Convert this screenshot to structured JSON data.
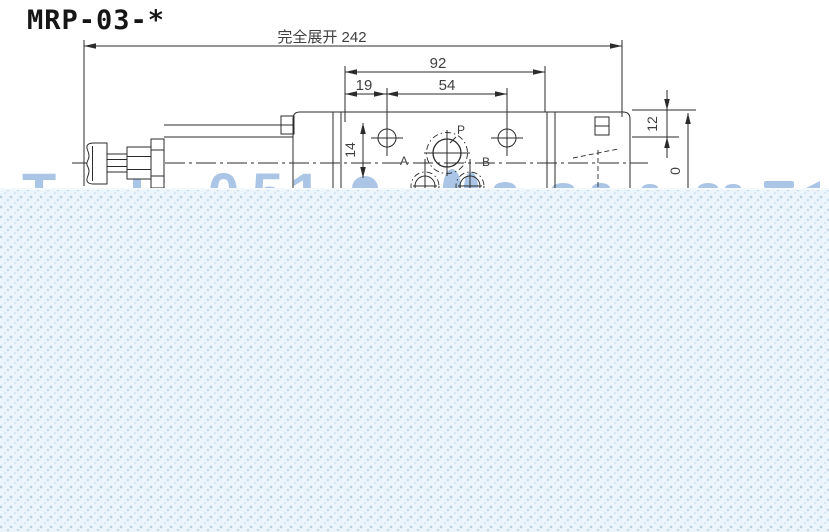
{
  "title": "MRP-03-*",
  "dimensions": {
    "overall_extended": "完全展开 242",
    "body_width": "92",
    "edge_to_hole": "19",
    "hole_spacing": "54",
    "hole_offset": "14",
    "top_height": "12",
    "partial_height": "0"
  },
  "port_labels": {
    "p": "P",
    "a": "A",
    "b": "B"
  },
  "watermark": {
    "letter_t": "T",
    "letter_l": "l",
    "colon": ":",
    "digit_0": "0",
    "digit_5": "5",
    "digit_1": "1"
  },
  "colors": {
    "line": "#2b2b2b",
    "dim_text": "#3f3f3f",
    "watermark_blue": "#9cbbe2",
    "band_background": "#ecf5fb",
    "band_dot": "#b9cfde"
  }
}
